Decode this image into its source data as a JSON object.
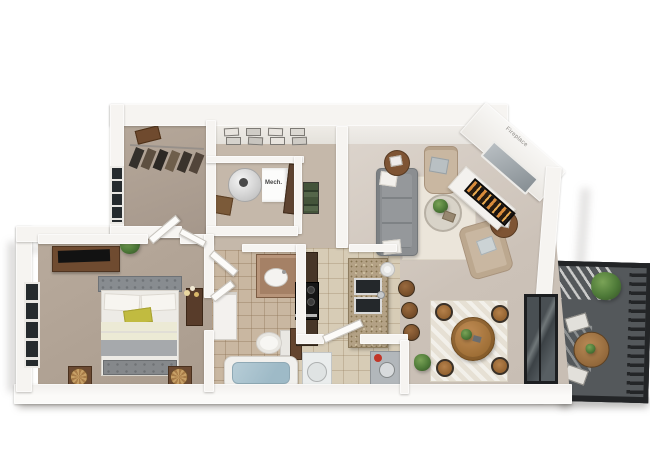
{
  "scene": {
    "width": 650,
    "height": 468,
    "background": "#ffffff",
    "description": "3D top-down rendering of a one-bedroom, one-bath apartment floor plan with balcony"
  },
  "labels": {
    "mech": "Mech.",
    "fireplace": "Fireplace"
  },
  "palette": {
    "wall": "#f6f4f1",
    "wall_face": "#e8e5e0",
    "living_floor": "#cfc5bb",
    "hall_floor": "#c5b8aa",
    "bedroom_carpet": "#b1a395",
    "bath_tile": "#c9b7a1",
    "kitchen_tile": "#d7ccb6",
    "cabinet_wood": "#473628",
    "granite_counter": "#b3a185",
    "sofa_gray": "#8b8e91",
    "armchair_beige": "#c9b7a1",
    "accent_pillow_yellow": "#c1bb40",
    "wood_furniture": "#a9743f",
    "rug_cream": "#ebe5da",
    "balcony_floor": "#54585b",
    "railing_black": "#232527",
    "tub_water": "#a9c2cd",
    "plant_green": "#4e7a38",
    "heater_cap_red": "#c13527"
  },
  "rooms": [
    {
      "name": "walk-in-closet",
      "items": [
        "hanging-clothes",
        "storage-box",
        "window"
      ]
    },
    {
      "name": "hallway",
      "items": [
        "gallery-picture-frames",
        "flower-console"
      ]
    },
    {
      "name": "mechanical-closet",
      "label": "Mech.",
      "items": [
        "water-heater-cylinder",
        "wood-crate",
        "wood-door",
        "shelf-with-linens"
      ]
    },
    {
      "name": "living-room",
      "items": [
        "gray-sofa",
        "armchair",
        "armchair",
        "round-coffee-table",
        "side-table",
        "side-table",
        "cream-area-rug",
        "corner-fireplace",
        "mirror",
        "potted-plant"
      ]
    },
    {
      "name": "bedroom",
      "items": [
        "upholstered-bed",
        "yellow-accent-pillow",
        "foot-bench",
        "dresser",
        "tv",
        "nightstand-lamp",
        "nightstand-lamp",
        "potted-plant",
        "bay-window"
      ]
    },
    {
      "name": "bathroom",
      "items": [
        "vanity-sink",
        "toilet",
        "bathtub",
        "linen-cabinet"
      ]
    },
    {
      "name": "kitchen",
      "items": [
        "dark-cabinets",
        "stove",
        "granite-peninsula",
        "double-sink",
        "paper-towel-roll",
        "bar-stool",
        "bar-stool",
        "bar-stool"
      ]
    },
    {
      "name": "laundry-utility-closet",
      "items": [
        "washer",
        "water-heater-tank"
      ]
    },
    {
      "name": "dining-area",
      "items": [
        "round-dining-table",
        "dining-chair",
        "dining-chair",
        "dining-chair",
        "dining-chair",
        "area-rug",
        "floor-plant",
        "sliding-glass-door"
      ]
    },
    {
      "name": "balcony",
      "items": [
        "metal-railing",
        "bistro-table",
        "patio-chair",
        "patio-chair",
        "large-plant"
      ]
    }
  ]
}
